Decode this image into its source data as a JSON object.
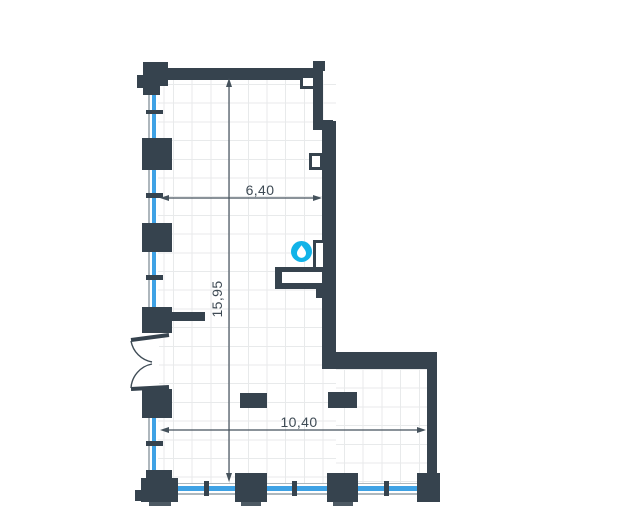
{
  "plan": {
    "type": "architectural-floor-plan",
    "dimensions": {
      "top_width": "6,40",
      "left_height": "15,95",
      "bottom_width": "10,40"
    },
    "icons": [
      {
        "name": "water-drop-icon",
        "color": "#12b3e8"
      }
    ],
    "colors": {
      "wall": "#36434e",
      "window_glass": "#3fa2e5",
      "grid": "#e8eaeb",
      "dimension_line": "#45525c",
      "floor": "#ffffff"
    }
  }
}
